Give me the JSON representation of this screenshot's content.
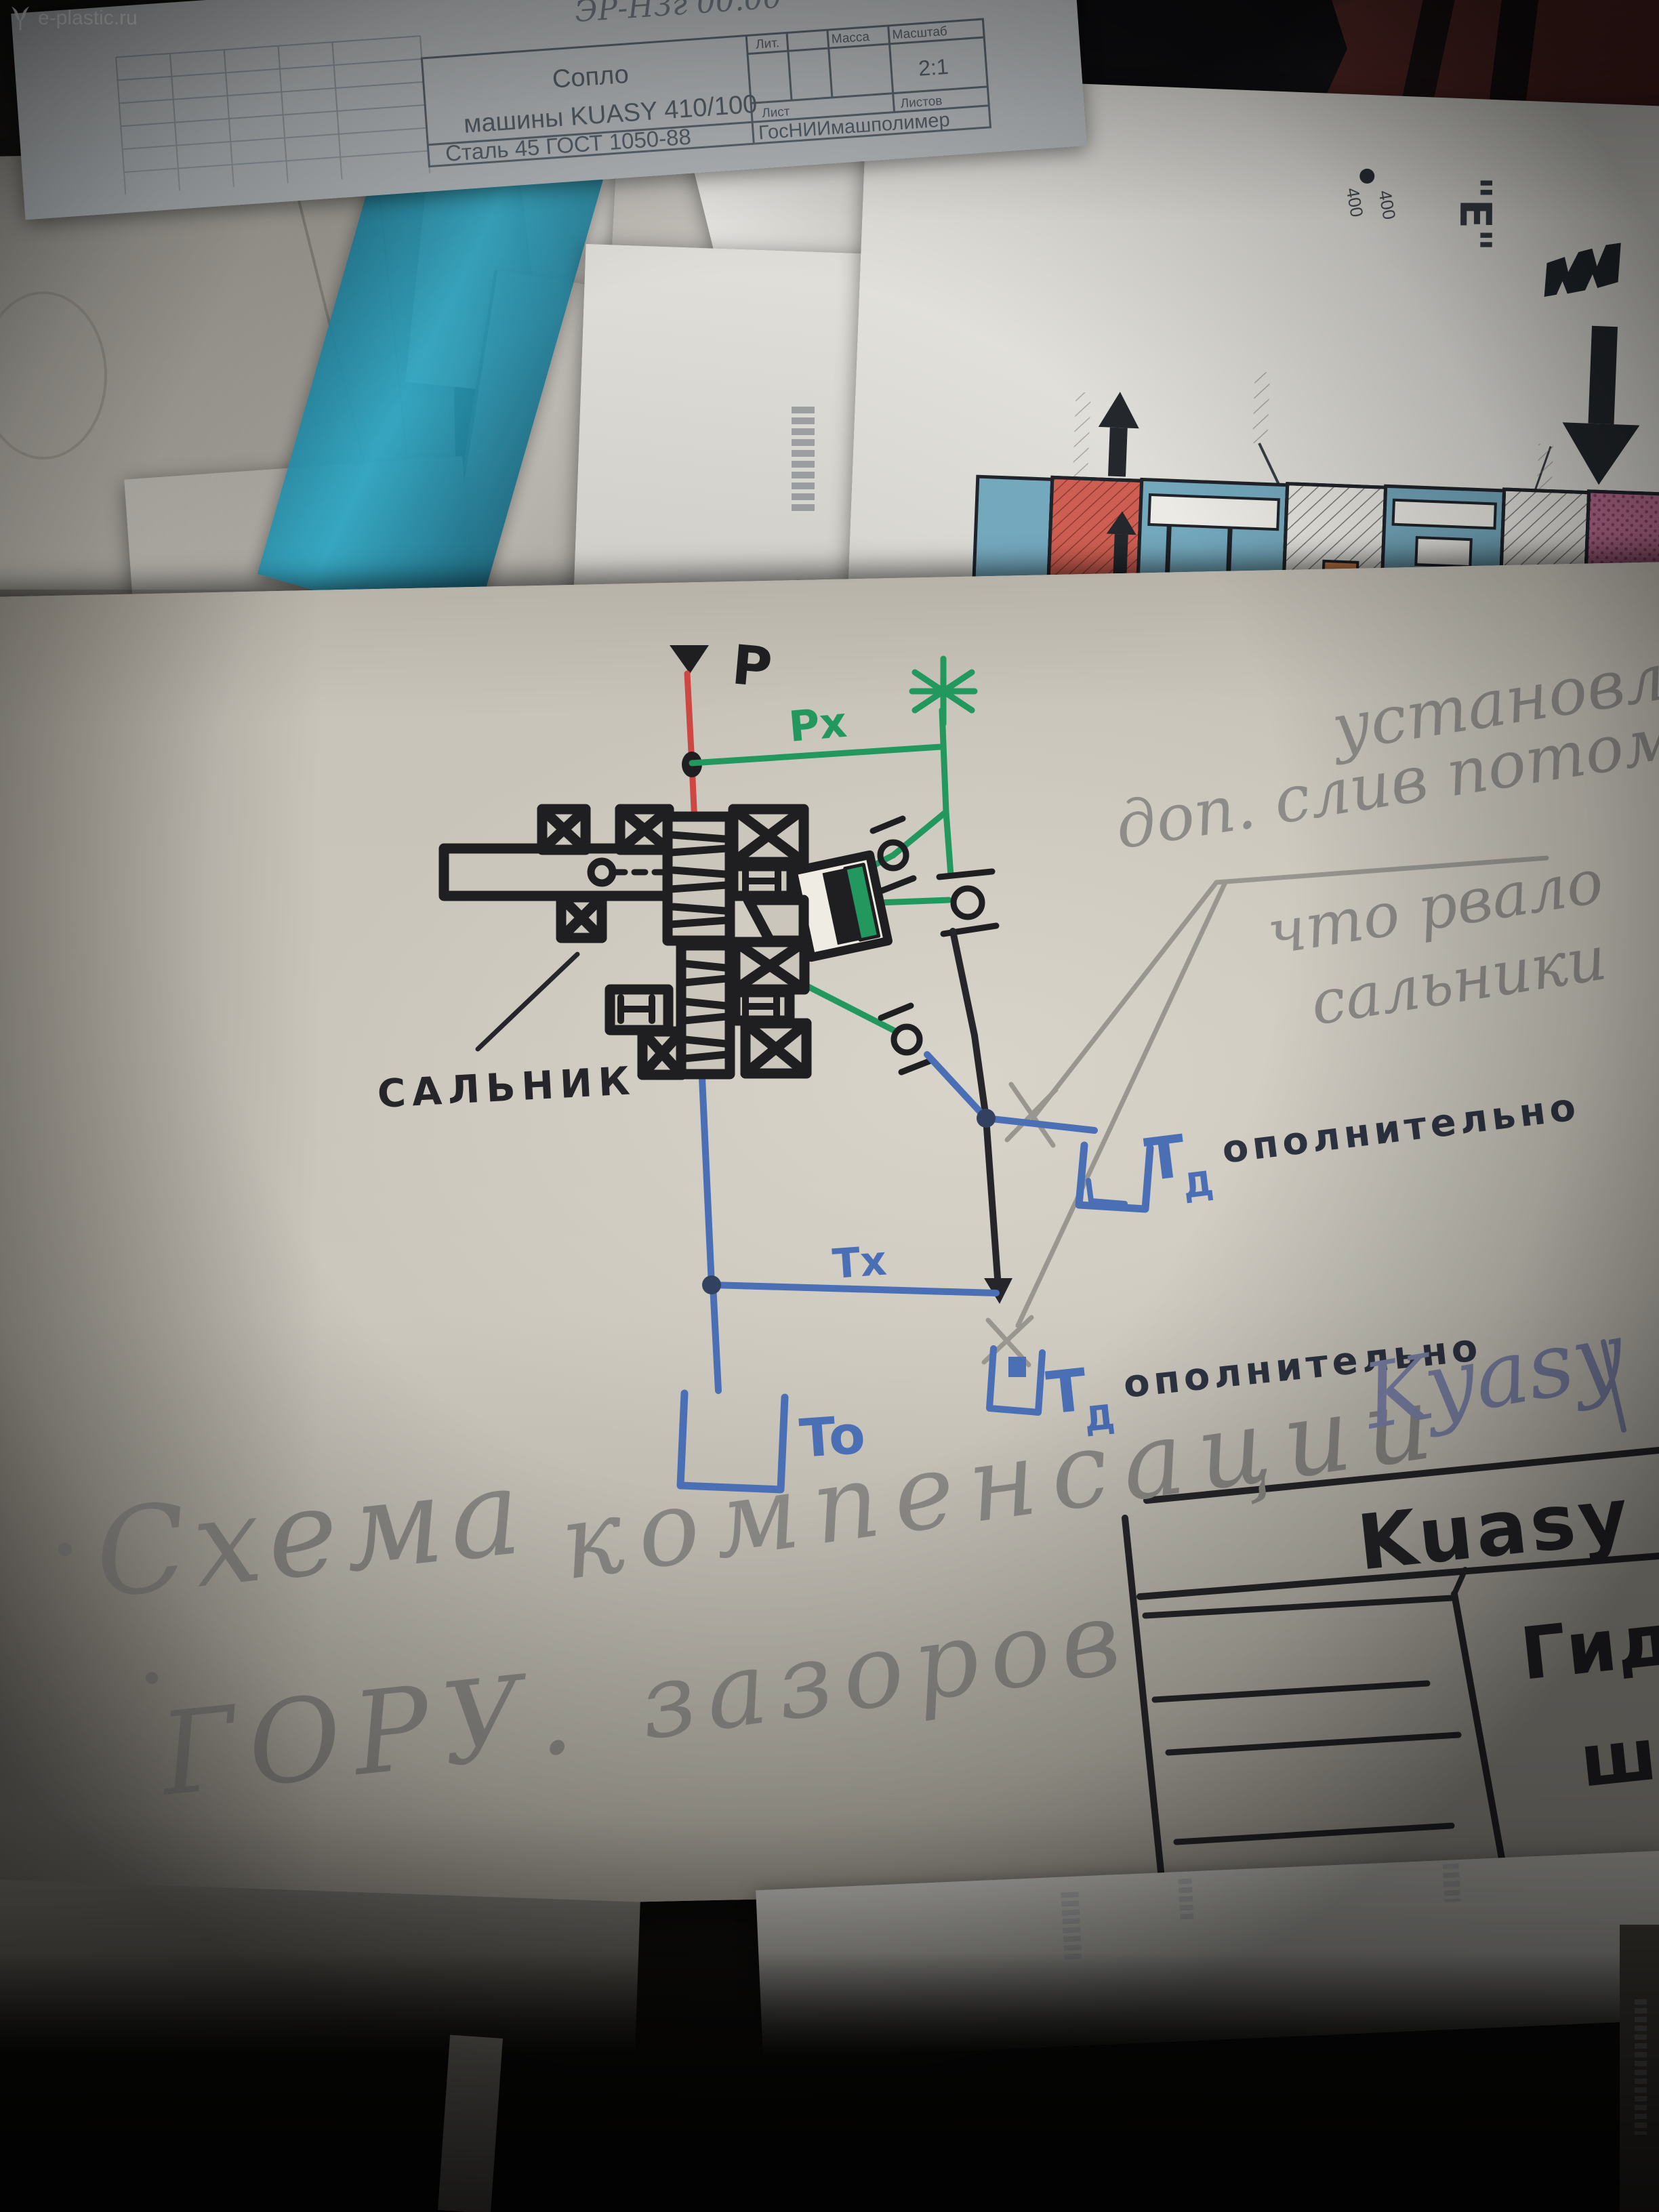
{
  "watermark": {
    "brand": "e-plastic.ru"
  },
  "blueprint": {
    "handwritten_code": "ЭР-НЗг 00.00",
    "part_title_line1": "Сопло",
    "part_title_line2": "машины KUASY 410/100",
    "header_lit": "Лит.",
    "header_massa": "Масса",
    "header_masshtab": "Масштаб",
    "scale_value": "2:1",
    "header_list": "Лист",
    "header_listov": "Листов",
    "material": "Сталь 45 ГОСТ 1050-88",
    "organization": "ГосНИИмашполимер"
  },
  "manual_page": {
    "rotated_marking": "\"E\"",
    "port_number_a": "400",
    "port_number_b": "400"
  },
  "schematic": {
    "label_p": "P",
    "label_px": "Px",
    "label_tx": "Tx",
    "label_to": "To",
    "label_salnik": "САЛЬНИК",
    "tank1_t": "Т",
    "tank1_sub": "Д",
    "tank1_suffix": "ополнительно",
    "tank2_t": "Т",
    "tank2_sub": "Д",
    "tank2_suffix": "ополнительно"
  },
  "pencil_note": {
    "line1": "установлен",
    "line2": "доп. слив потому",
    "line3": "что рвало",
    "line4": "сальники"
  },
  "caption": {
    "word1": "Схема",
    "word2": "компенсации",
    "word3": "ГОРУ.",
    "word4": "зазоров",
    "signature": "Kyasy"
  },
  "title_block": {
    "machine": "Kuasy 26",
    "doc_type": "Гидро",
    "doc_type2": "ш"
  },
  "colors": {
    "ink_green": "#22985e",
    "ink_red": "#cf4742",
    "ink_blue": "#4a6fb5",
    "marker_black": "#1f1f22",
    "pencil_grey": "#8e8c88",
    "pencil_blue": "#7d84a8",
    "envelope_paper": "#c8c4ba",
    "section_blue": "#74a8bd",
    "section_red": "#cd5f52",
    "section_pink": "#bc6f93",
    "wall_maroon": "#5d2a2a"
  }
}
